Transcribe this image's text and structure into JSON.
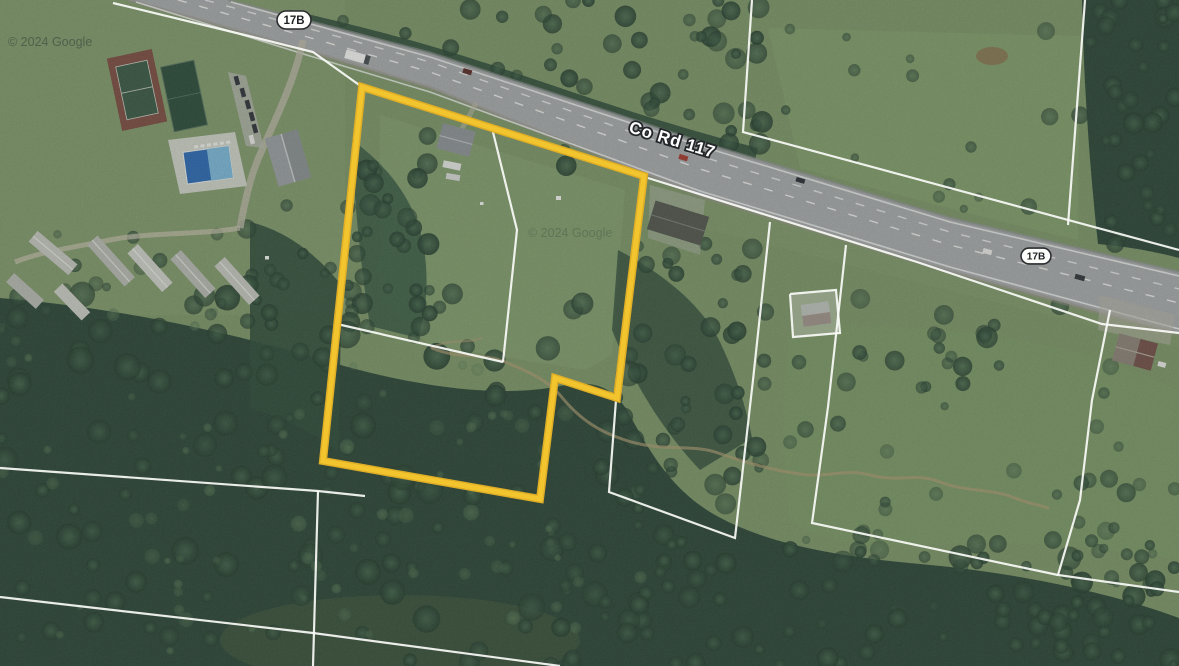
{
  "map": {
    "road_label": "Co Rd 117",
    "route_shields": [
      {
        "label": "17B"
      },
      {
        "label": "17B"
      }
    ],
    "watermark_topleft": "© 2024 Google",
    "watermark_center": "© 2024 Google",
    "colors": {
      "parcel_highlight": "#F2C52F",
      "parcel_highlight_edge": "#DFAE26",
      "parcel_boundary": "#FAFBF7",
      "road_surface": "#A7ABAA",
      "field_green": "#7D9769",
      "forest_green": "#2F4A3A",
      "pool_blue": "#3A74B8",
      "creek_tan": "#AD9C74"
    },
    "highlighted_parcel": {
      "points": [
        [
          362,
          87
        ],
        [
          644,
          176
        ],
        [
          630,
          290
        ],
        [
          617,
          398
        ],
        [
          555,
          378
        ],
        [
          540,
          499
        ],
        [
          323,
          461
        ]
      ]
    },
    "parcel_lines": [
      [
        [
          113,
          3
        ],
        [
          253,
          37
        ],
        [
          313,
          52
        ],
        [
          362,
          87
        ]
      ],
      [
        [
          648,
          178
        ],
        [
          917,
          262
        ],
        [
          1102,
          324
        ],
        [
          1179,
          333
        ]
      ],
      [
        [
          752,
          0
        ],
        [
          743,
          132
        ],
        [
          1179,
          250
        ]
      ],
      [
        [
          1085,
          0
        ],
        [
          1068,
          225
        ]
      ],
      [
        [
          770,
          222
        ],
        [
          753,
          380
        ],
        [
          735,
          538
        ],
        [
          609,
          492
        ],
        [
          616,
          400
        ]
      ],
      [
        [
          846,
          245
        ],
        [
          828,
          407
        ],
        [
          812,
          523
        ],
        [
          1058,
          575
        ]
      ],
      [
        [
          1110,
          310
        ],
        [
          1092,
          400
        ],
        [
          1080,
          500
        ],
        [
          1058,
          575
        ],
        [
          1179,
          592
        ]
      ],
      [
        [
          0,
          468
        ],
        [
          318,
          491
        ],
        [
          365,
          496
        ]
      ],
      [
        [
          318,
          491
        ],
        [
          313,
          666
        ]
      ],
      [
        [
          0,
          597
        ],
        [
          313,
          633
        ],
        [
          560,
          666
        ]
      ],
      [
        [
          492,
          128
        ],
        [
          517,
          230
        ],
        [
          503,
          362
        ]
      ],
      [
        [
          337,
          324
        ],
        [
          503,
          362
        ]
      ],
      [
        [
          790,
          294
        ],
        [
          836,
          290
        ],
        [
          840,
          333
        ],
        [
          793,
          337
        ],
        [
          790,
          294
        ]
      ]
    ]
  }
}
